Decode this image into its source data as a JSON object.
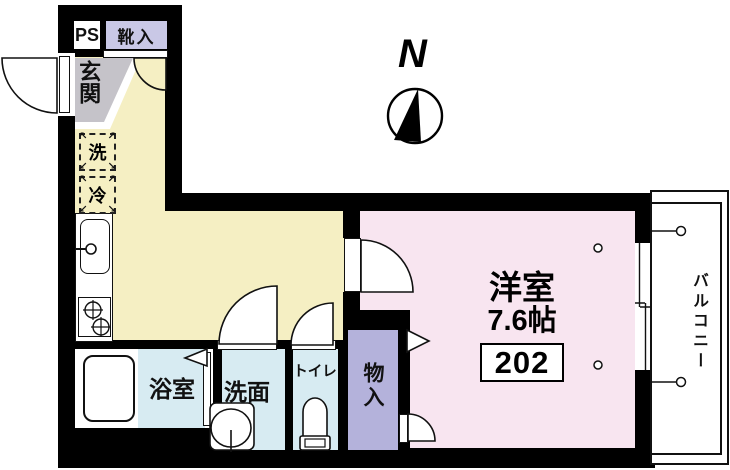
{
  "floorplan": {
    "unit_number": "202",
    "main_room": {
      "name": "洋室",
      "size": "7.6帖"
    },
    "compass": {
      "label": "N"
    },
    "labels": {
      "pipe_space": "PS",
      "shoe_cabinet": "靴入",
      "entrance": "玄関",
      "washer": "洗",
      "refrigerator": "冷",
      "bathroom": "浴室",
      "washroom": "洗面",
      "toilet": "トイレ",
      "storage": "物入",
      "balcony": "バルコニー"
    },
    "symbols": {
      "arrow_tl": "↖",
      "arrow_tr": "↗",
      "arrow_bl": "↙",
      "arrow_br": "↘"
    },
    "colors": {
      "wall": "#000000",
      "hall_kitchen": "#F5EFC3",
      "main_room": "#F8E5F0",
      "wet_area": "#D7EBF2",
      "shoe_cabinet": "#C9C8E6",
      "storage": "#B4B2DB",
      "entrance": "#C5C3C9",
      "balcony": "#FFFFFF"
    }
  }
}
